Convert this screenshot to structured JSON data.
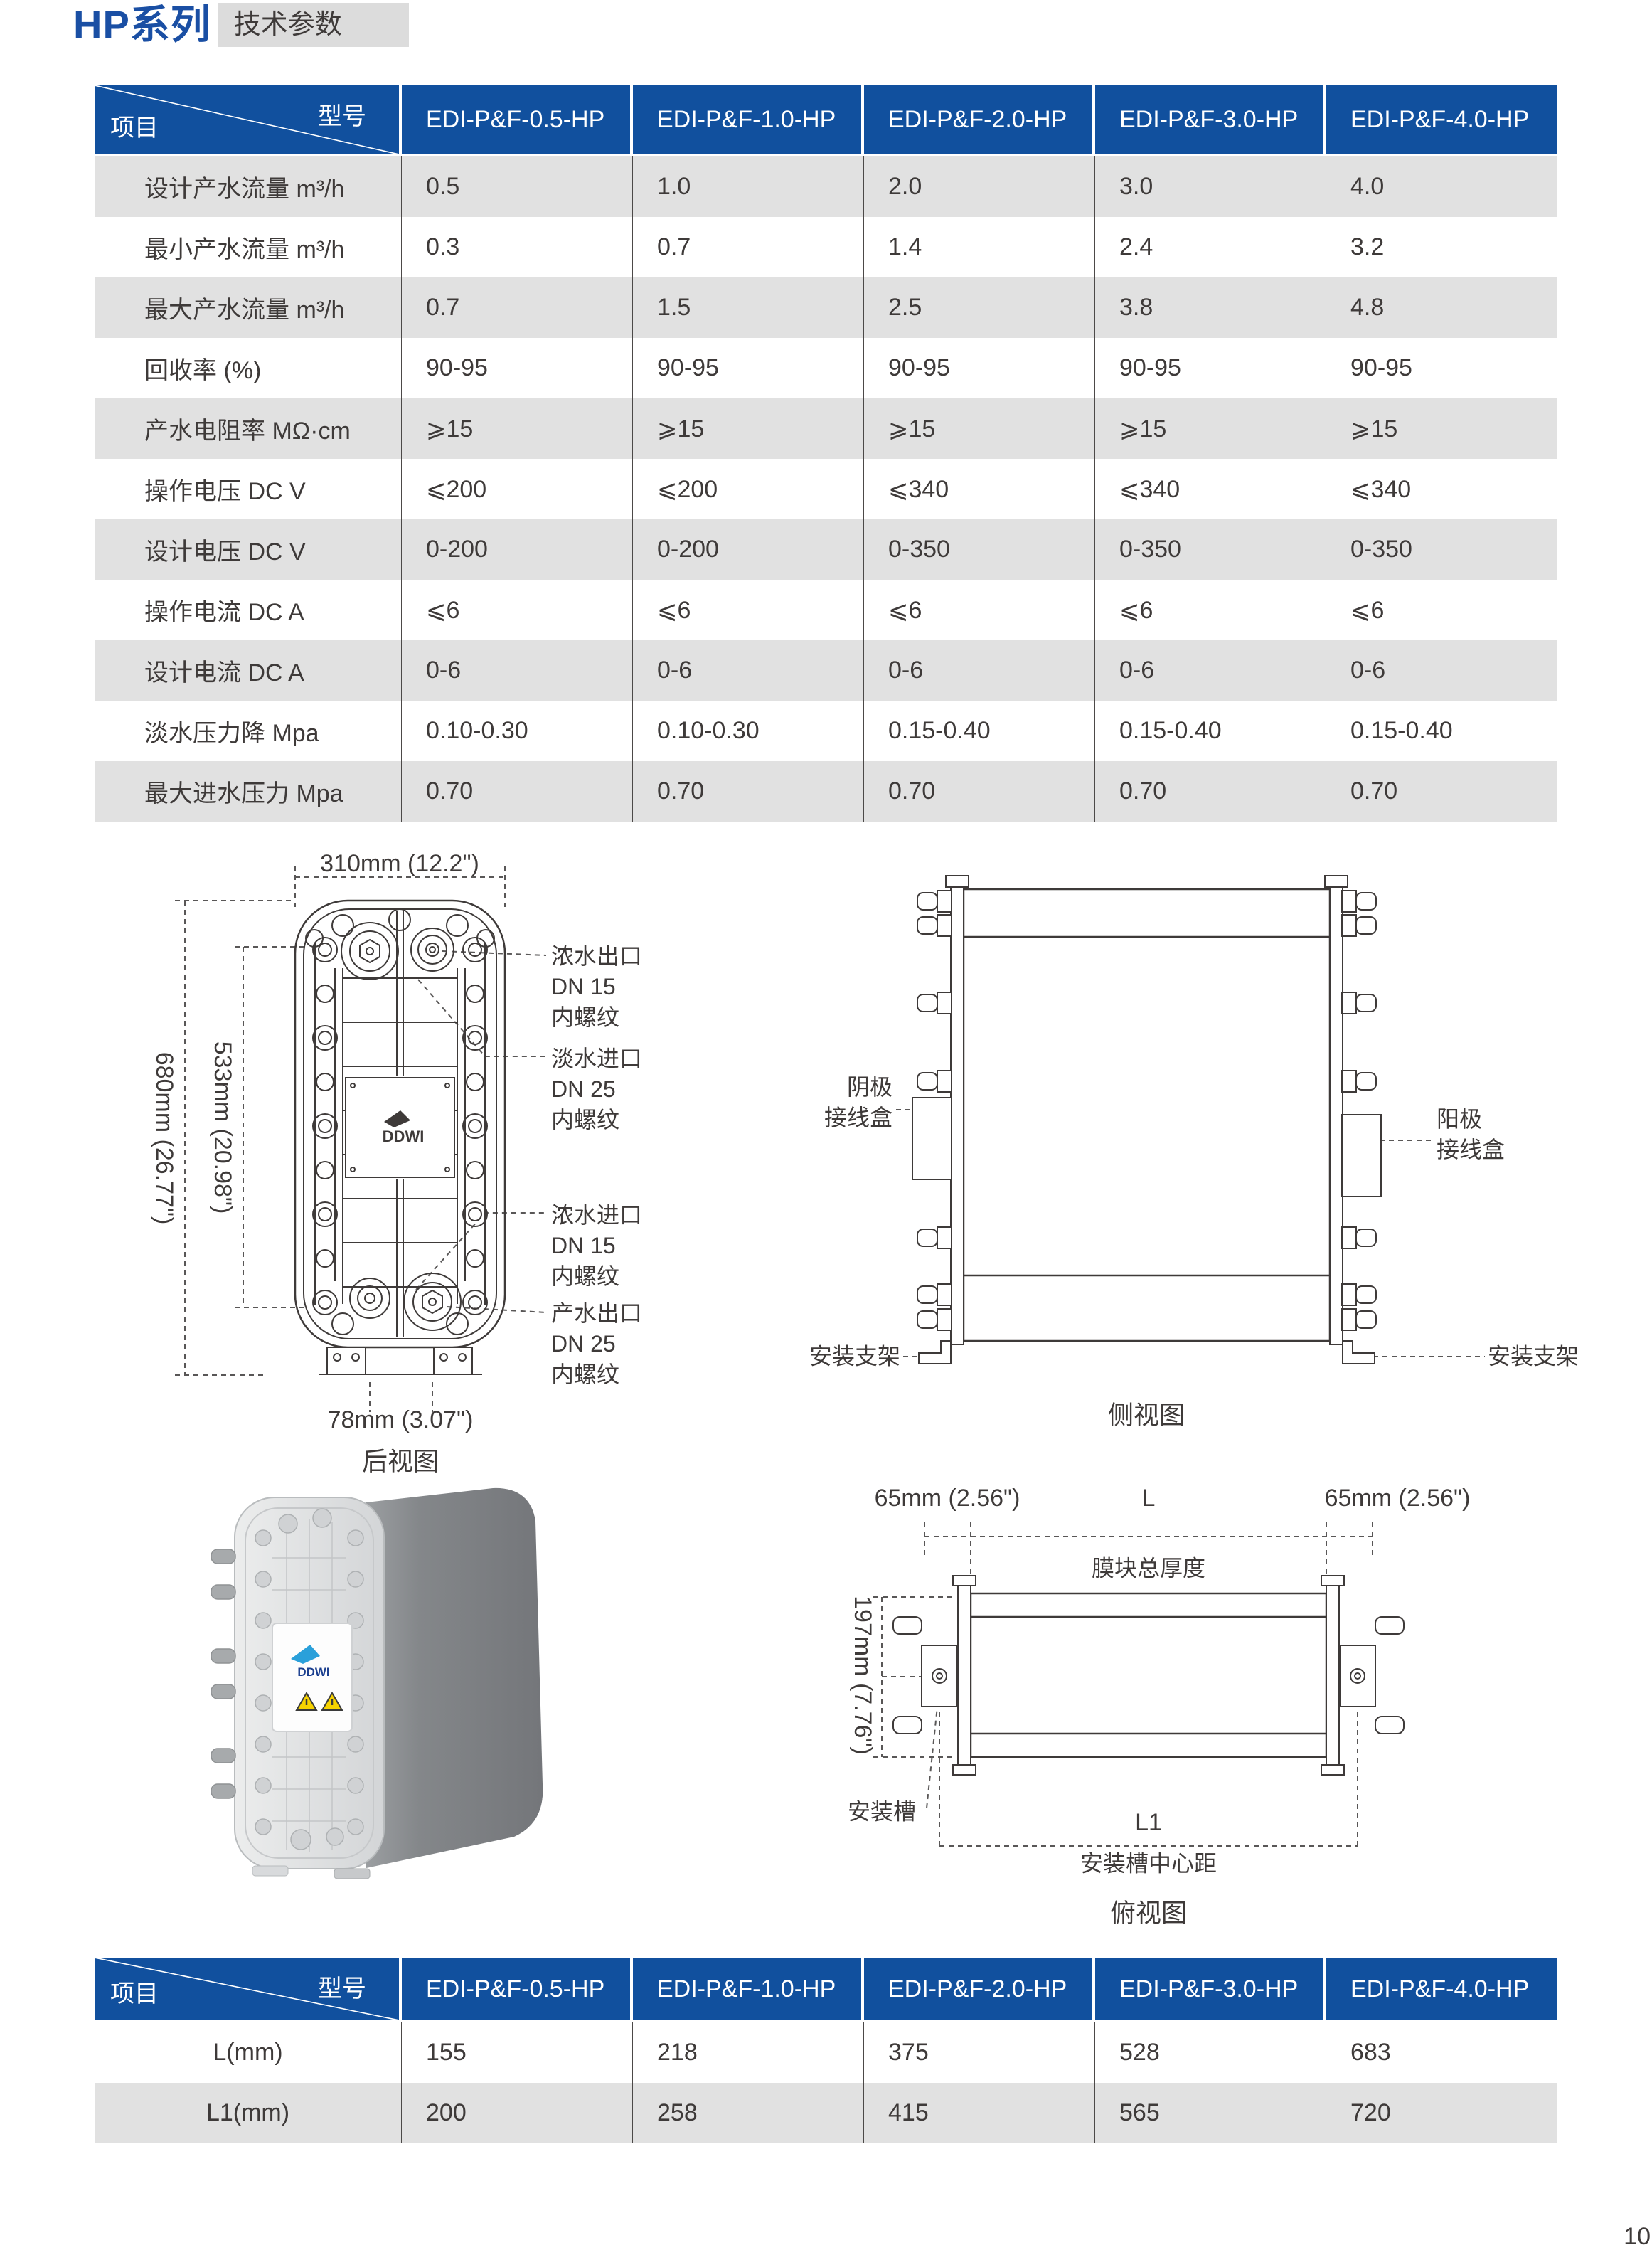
{
  "colors": {
    "header_blue": "#11509e",
    "title_blue": "#1a4fa4",
    "badge_bg": "#dcdcdc",
    "row_stripe": "#e1e1e1",
    "text": "#3e3a39",
    "line": "#595757"
  },
  "header": {
    "series": "HP",
    "series_suffix": "系列",
    "badge": "技术参数",
    "page_number": "10"
  },
  "spec_table": {
    "corner": {
      "top": "型号",
      "bottom": "项目"
    },
    "columns": [
      "EDI-P&F-0.5-HP",
      "EDI-P&F-1.0-HP",
      "EDI-P&F-2.0-HP",
      "EDI-P&F-3.0-HP",
      "EDI-P&F-4.0-HP"
    ],
    "rows": [
      {
        "label": "设计产水流量 m³/h",
        "values": [
          "0.5",
          "1.0",
          "2.0",
          "3.0",
          "4.0"
        ]
      },
      {
        "label": "最小产水流量 m³/h",
        "values": [
          "0.3",
          "0.7",
          "1.4",
          "2.4",
          "3.2"
        ]
      },
      {
        "label": "最大产水流量 m³/h",
        "values": [
          "0.7",
          "1.5",
          "2.5",
          "3.8",
          "4.8"
        ]
      },
      {
        "label": "回收率 (%)",
        "values": [
          "90-95",
          "90-95",
          "90-95",
          "90-95",
          "90-95"
        ]
      },
      {
        "label": "产水电阻率 MΩ·cm",
        "values": [
          "⩾15",
          "⩾15",
          "⩾15",
          "⩾15",
          "⩾15"
        ]
      },
      {
        "label": "操作电压 DC V",
        "values": [
          "⩽200",
          "⩽200",
          "⩽340",
          "⩽340",
          "⩽340"
        ]
      },
      {
        "label": "设计电压 DC V",
        "values": [
          "0-200",
          "0-200",
          "0-350",
          "0-350",
          "0-350"
        ]
      },
      {
        "label": "操作电流 DC A",
        "values": [
          "⩽6",
          "⩽6",
          "⩽6",
          "⩽6",
          "⩽6"
        ]
      },
      {
        "label": "设计电流 DC A",
        "values": [
          "0-6",
          "0-6",
          "0-6",
          "0-6",
          "0-6"
        ]
      },
      {
        "label": "淡水压力降 Mpa",
        "values": [
          "0.10-0.30",
          "0.10-0.30",
          "0.15-0.40",
          "0.15-0.40",
          "0.15-0.40"
        ]
      },
      {
        "label": "最大进水压力 Mpa",
        "values": [
          "0.70",
          "0.70",
          "0.70",
          "0.70",
          "0.70"
        ]
      }
    ]
  },
  "dimension_table": {
    "corner": {
      "top": "型号",
      "bottom": "项目"
    },
    "columns": [
      "EDI-P&F-0.5-HP",
      "EDI-P&F-1.0-HP",
      "EDI-P&F-2.0-HP",
      "EDI-P&F-3.0-HP",
      "EDI-P&F-4.0-HP"
    ],
    "rows": [
      {
        "label": "L(mm)",
        "values": [
          "155",
          "218",
          "375",
          "528",
          "683"
        ]
      },
      {
        "label": "L1(mm)",
        "values": [
          "200",
          "258",
          "415",
          "565",
          "720"
        ]
      }
    ]
  },
  "rear_view": {
    "caption": "后视图",
    "dim_width": "310mm (12.2\")",
    "dim_height_outer": "680mm (26.77\")",
    "dim_height_inner": "533mm (20.98\")",
    "dim_ports": "78mm (3.07\")",
    "label_concentrate_outlet": "浓水出口\nDN 15\n内螺纹",
    "label_dilute_inlet": "淡水进口\nDN 25\n内螺纹",
    "label_concentrate_inlet": "浓水进口\nDN 15\n内螺纹",
    "label_product_outlet": "产水出口\nDN 25\n内螺纹",
    "logo": "DDWI"
  },
  "side_view": {
    "caption": "侧视图",
    "cathode_box": "阴极\n接线盒",
    "anode_box": "阳极\n接线盒",
    "bracket_left": "安装支架",
    "bracket_right": "安装支架"
  },
  "top_view": {
    "caption": "俯视图",
    "dim_left": "65mm (2.56\")",
    "dim_l": "L",
    "dim_right": "65mm (2.56\")",
    "stack_thickness": "膜块总厚度",
    "dim_depth": "197mm (7.76\")",
    "slot": "安装槽",
    "dim_l1": "L1",
    "slot_center": "安装槽中心距"
  },
  "product_photo": {
    "logo": "DDWI"
  }
}
